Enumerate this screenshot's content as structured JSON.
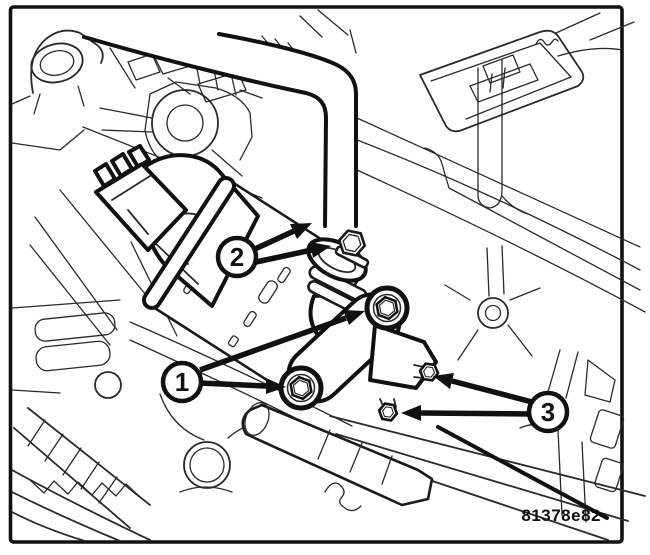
{
  "diagram": {
    "figure_code": "81378e82",
    "callouts": [
      {
        "label": "1"
      },
      {
        "label": "2"
      },
      {
        "label": "3"
      }
    ],
    "colors": {
      "line": "#111111",
      "background": "#ffffff"
    }
  }
}
